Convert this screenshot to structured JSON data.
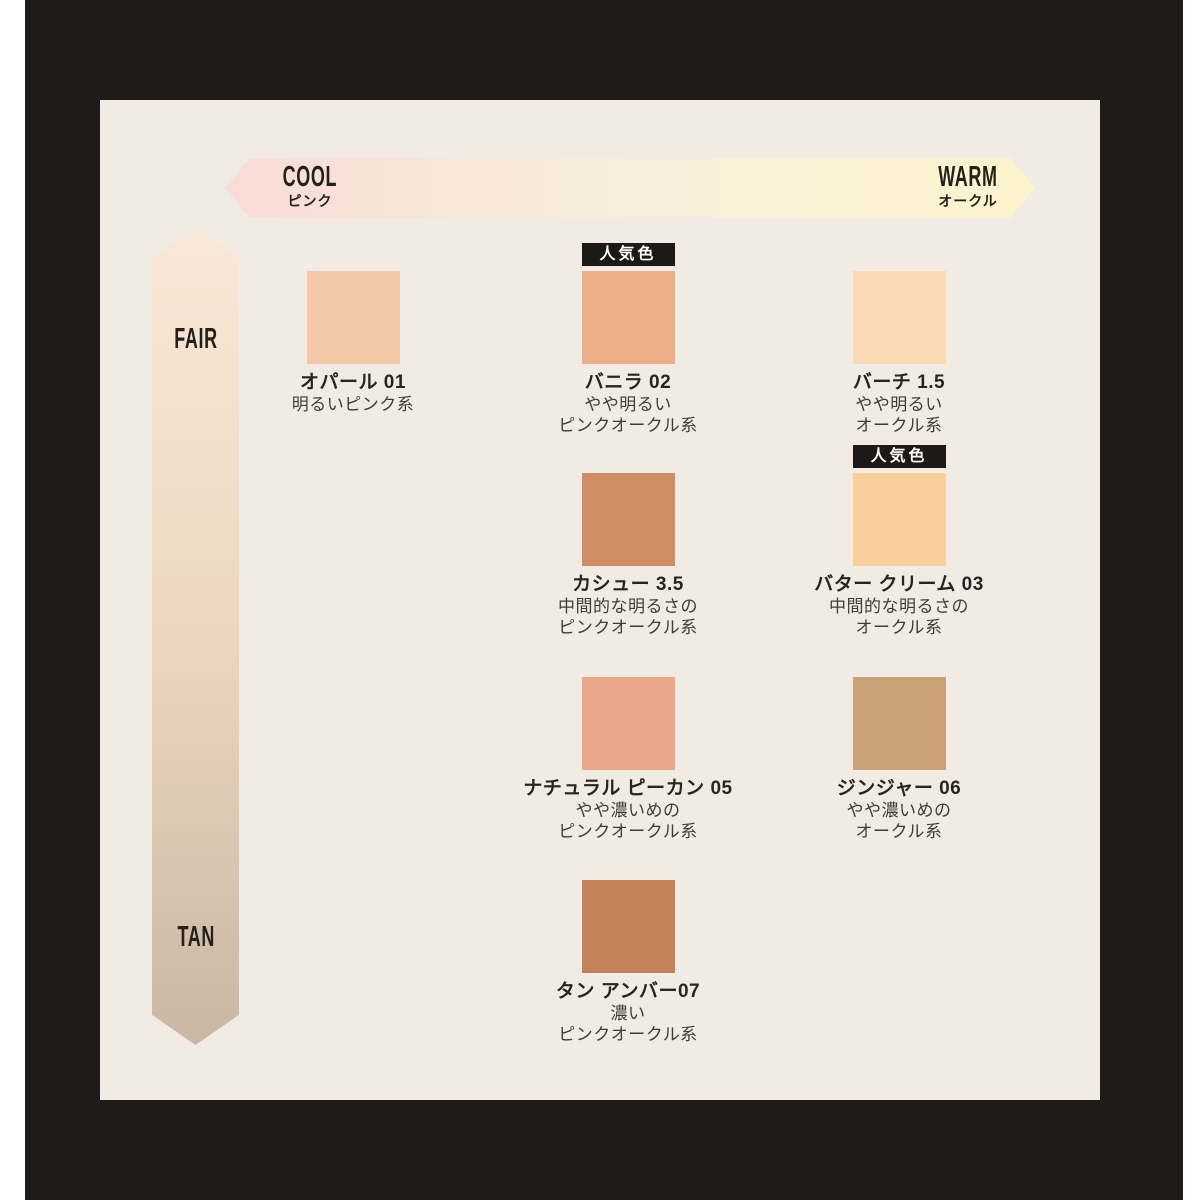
{
  "colors": {
    "frame": "#1c1b19",
    "panel_bg": "#f1ebe4",
    "badge_bg": "#1c1a17",
    "badge_text": "#ffffff"
  },
  "badge_label": "人気色",
  "axes": {
    "horizontal": {
      "left_label": "COOL",
      "left_sublabel": "ピンク",
      "right_label": "WARM",
      "right_sublabel": "オークル",
      "gradient_left": "#f9dcd6",
      "gradient_mid": "#f8eddc",
      "gradient_right": "#fdf4cd"
    },
    "vertical": {
      "top_label": "FAIR",
      "bottom_label": "TAN",
      "gradient_top": "#f9e8d6",
      "gradient_mid": "#ecd6c1",
      "gradient_bottom": "#c9b6a3"
    }
  },
  "shades": [
    {
      "name": "オパール 01",
      "desc1": "明るいピンク系",
      "desc2": "",
      "swatch_color": "#f3c7a7",
      "popular": false
    },
    {
      "name": "バニラ 02",
      "desc1": "やや明るい",
      "desc2": "ピンクオークル系",
      "swatch_color": "#edae8a",
      "popular": true
    },
    {
      "name": "バーチ 1.5",
      "desc1": "やや明るい",
      "desc2": "オークル系",
      "swatch_color": "#fbd9b2",
      "popular": false
    },
    {
      "name": "カシュー 3.5",
      "desc1": "中間的な明るさの",
      "desc2": "ピンクオークル系",
      "swatch_color": "#d08d65",
      "popular": false
    },
    {
      "name": "バター クリーム 03",
      "desc1": "中間的な明るさの",
      "desc2": "オークル系",
      "swatch_color": "#fbcf9b",
      "popular": true
    },
    {
      "name": "ナチュラル ピーカン 05",
      "desc1": "やや濃いめの",
      "desc2": "ピンクオークル系",
      "swatch_color": "#e9a889",
      "popular": false
    },
    {
      "name": "ジンジャー 06",
      "desc1": "やや濃いめの",
      "desc2": "オークル系",
      "swatch_color": "#c9a077",
      "popular": false
    },
    {
      "name": "タン アンバー07",
      "desc1": "濃い",
      "desc2": "ピンクオークル系",
      "swatch_color": "#c28157",
      "popular": false
    }
  ]
}
